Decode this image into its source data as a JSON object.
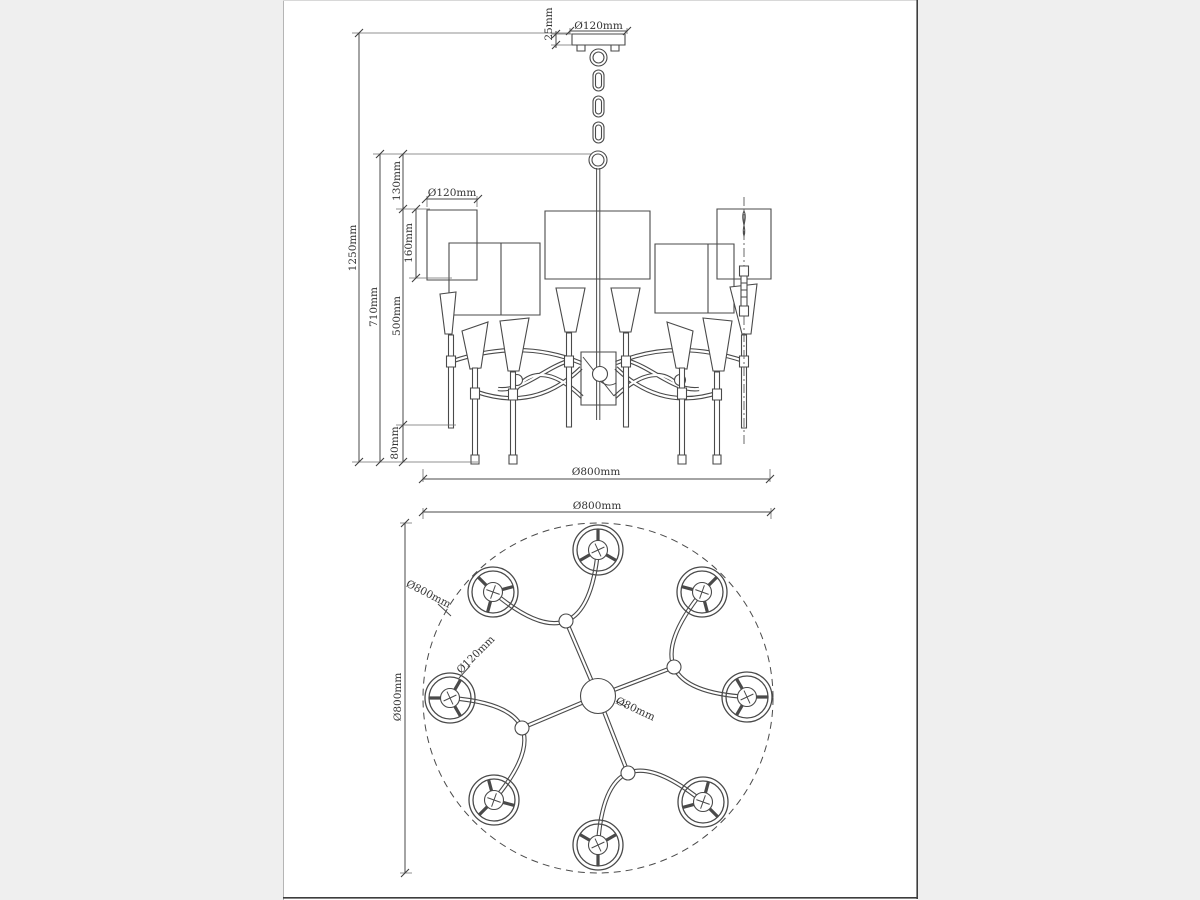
{
  "colors": {
    "line": "#4a4a4a",
    "text": "#333333",
    "page_background": "#ffffff",
    "margin_background": "#efefef"
  },
  "front_view": {
    "dimensions": {
      "canopy_diameter": "Ø120mm",
      "canopy_height": "25mm",
      "overall_height": "1250mm",
      "body_height": "710mm",
      "chain_drop": "130mm",
      "shade_height": "160mm",
      "body_section": "500mm",
      "finial_length": "80mm",
      "shade_diameter": "Ø120mm",
      "fixture_diameter": "Ø800mm"
    }
  },
  "plan_view": {
    "lamp_count": 8,
    "dimensions": {
      "fixture_width": "Ø800mm",
      "fixture_height": "Ø800mm",
      "ring_diameter": "Ø800mm",
      "shade_diameter": "Ø120mm",
      "hub_diameter": "Ø80mm"
    }
  }
}
